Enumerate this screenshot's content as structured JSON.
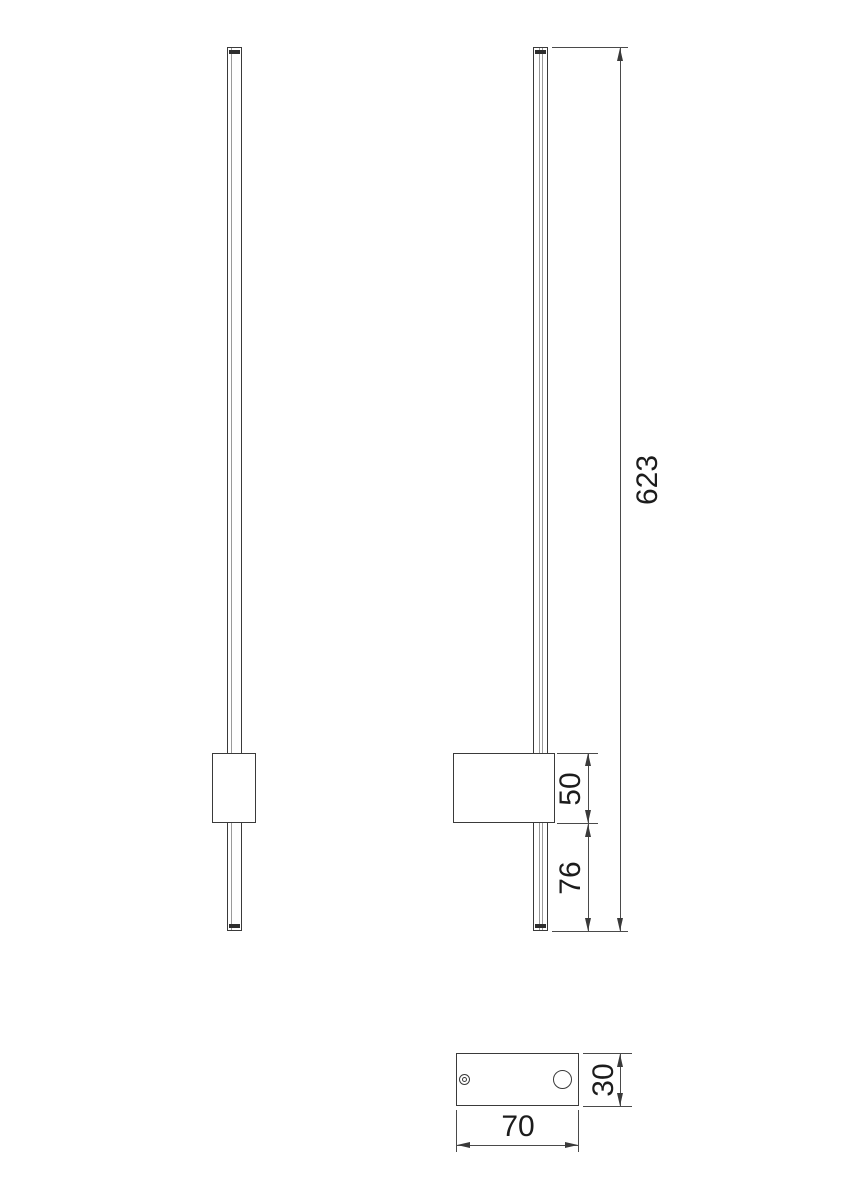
{
  "drawing": {
    "colors": {
      "background": "#ffffff",
      "object_line": "#3a3a3a",
      "dimension_line": "#4a4a4a",
      "text": "#1c1c1c"
    },
    "dimensions": {
      "total_height": "623",
      "bracket_height": "50",
      "bar_below_bracket": "76",
      "base_plate_width": "70",
      "base_plate_depth": "30"
    }
  }
}
